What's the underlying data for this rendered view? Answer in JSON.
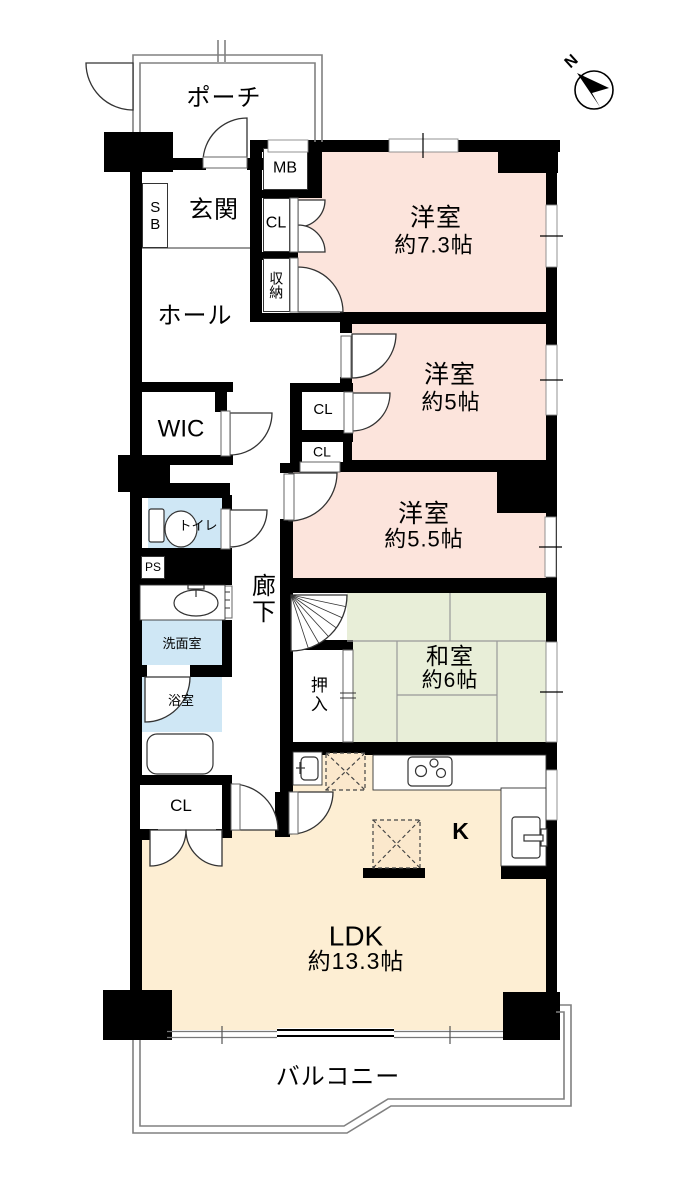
{
  "colors": {
    "western_room": "#fce4dc",
    "japanese_room": "#e8eed8",
    "ldk": "#fdeed3",
    "wet_area": "#cfe7f5",
    "appliance_box": "#fbe8cc",
    "wall": "#000000",
    "outline": "#808080"
  },
  "compass": {
    "north_label": "N"
  },
  "rooms": {
    "porch": {
      "label": "ポーチ"
    },
    "entrance": {
      "label": "玄関"
    },
    "shoe_box": {
      "label": "SB"
    },
    "meter_box": {
      "label": "MB"
    },
    "closet_entrance": {
      "label": "CL"
    },
    "storage": {
      "label": "収納"
    },
    "hall": {
      "label": "ホール"
    },
    "western_room_1": {
      "name": "洋室",
      "size": "約7.3帖"
    },
    "western_room_2": {
      "name": "洋室",
      "size": "約5帖"
    },
    "closet_w2": {
      "label": "CL"
    },
    "closet_w3": {
      "label": "CL"
    },
    "western_room_3": {
      "name": "洋室",
      "size": "約5.5帖"
    },
    "wic": {
      "label": "WIC"
    },
    "toilet": {
      "label": "トイレ"
    },
    "pipe_space": {
      "label": "PS"
    },
    "washroom": {
      "label": "洗面室"
    },
    "bathroom": {
      "label": "浴室"
    },
    "corridor": {
      "label": "廊下"
    },
    "oshiire": {
      "label": "押入"
    },
    "japanese_room": {
      "name": "和室",
      "size": "約6帖"
    },
    "kitchen": {
      "label": "K"
    },
    "closet_ldk": {
      "label": "CL"
    },
    "ldk": {
      "name": "LDK",
      "size": "約13.3帖"
    },
    "balcony": {
      "label": "バルコニー"
    }
  }
}
